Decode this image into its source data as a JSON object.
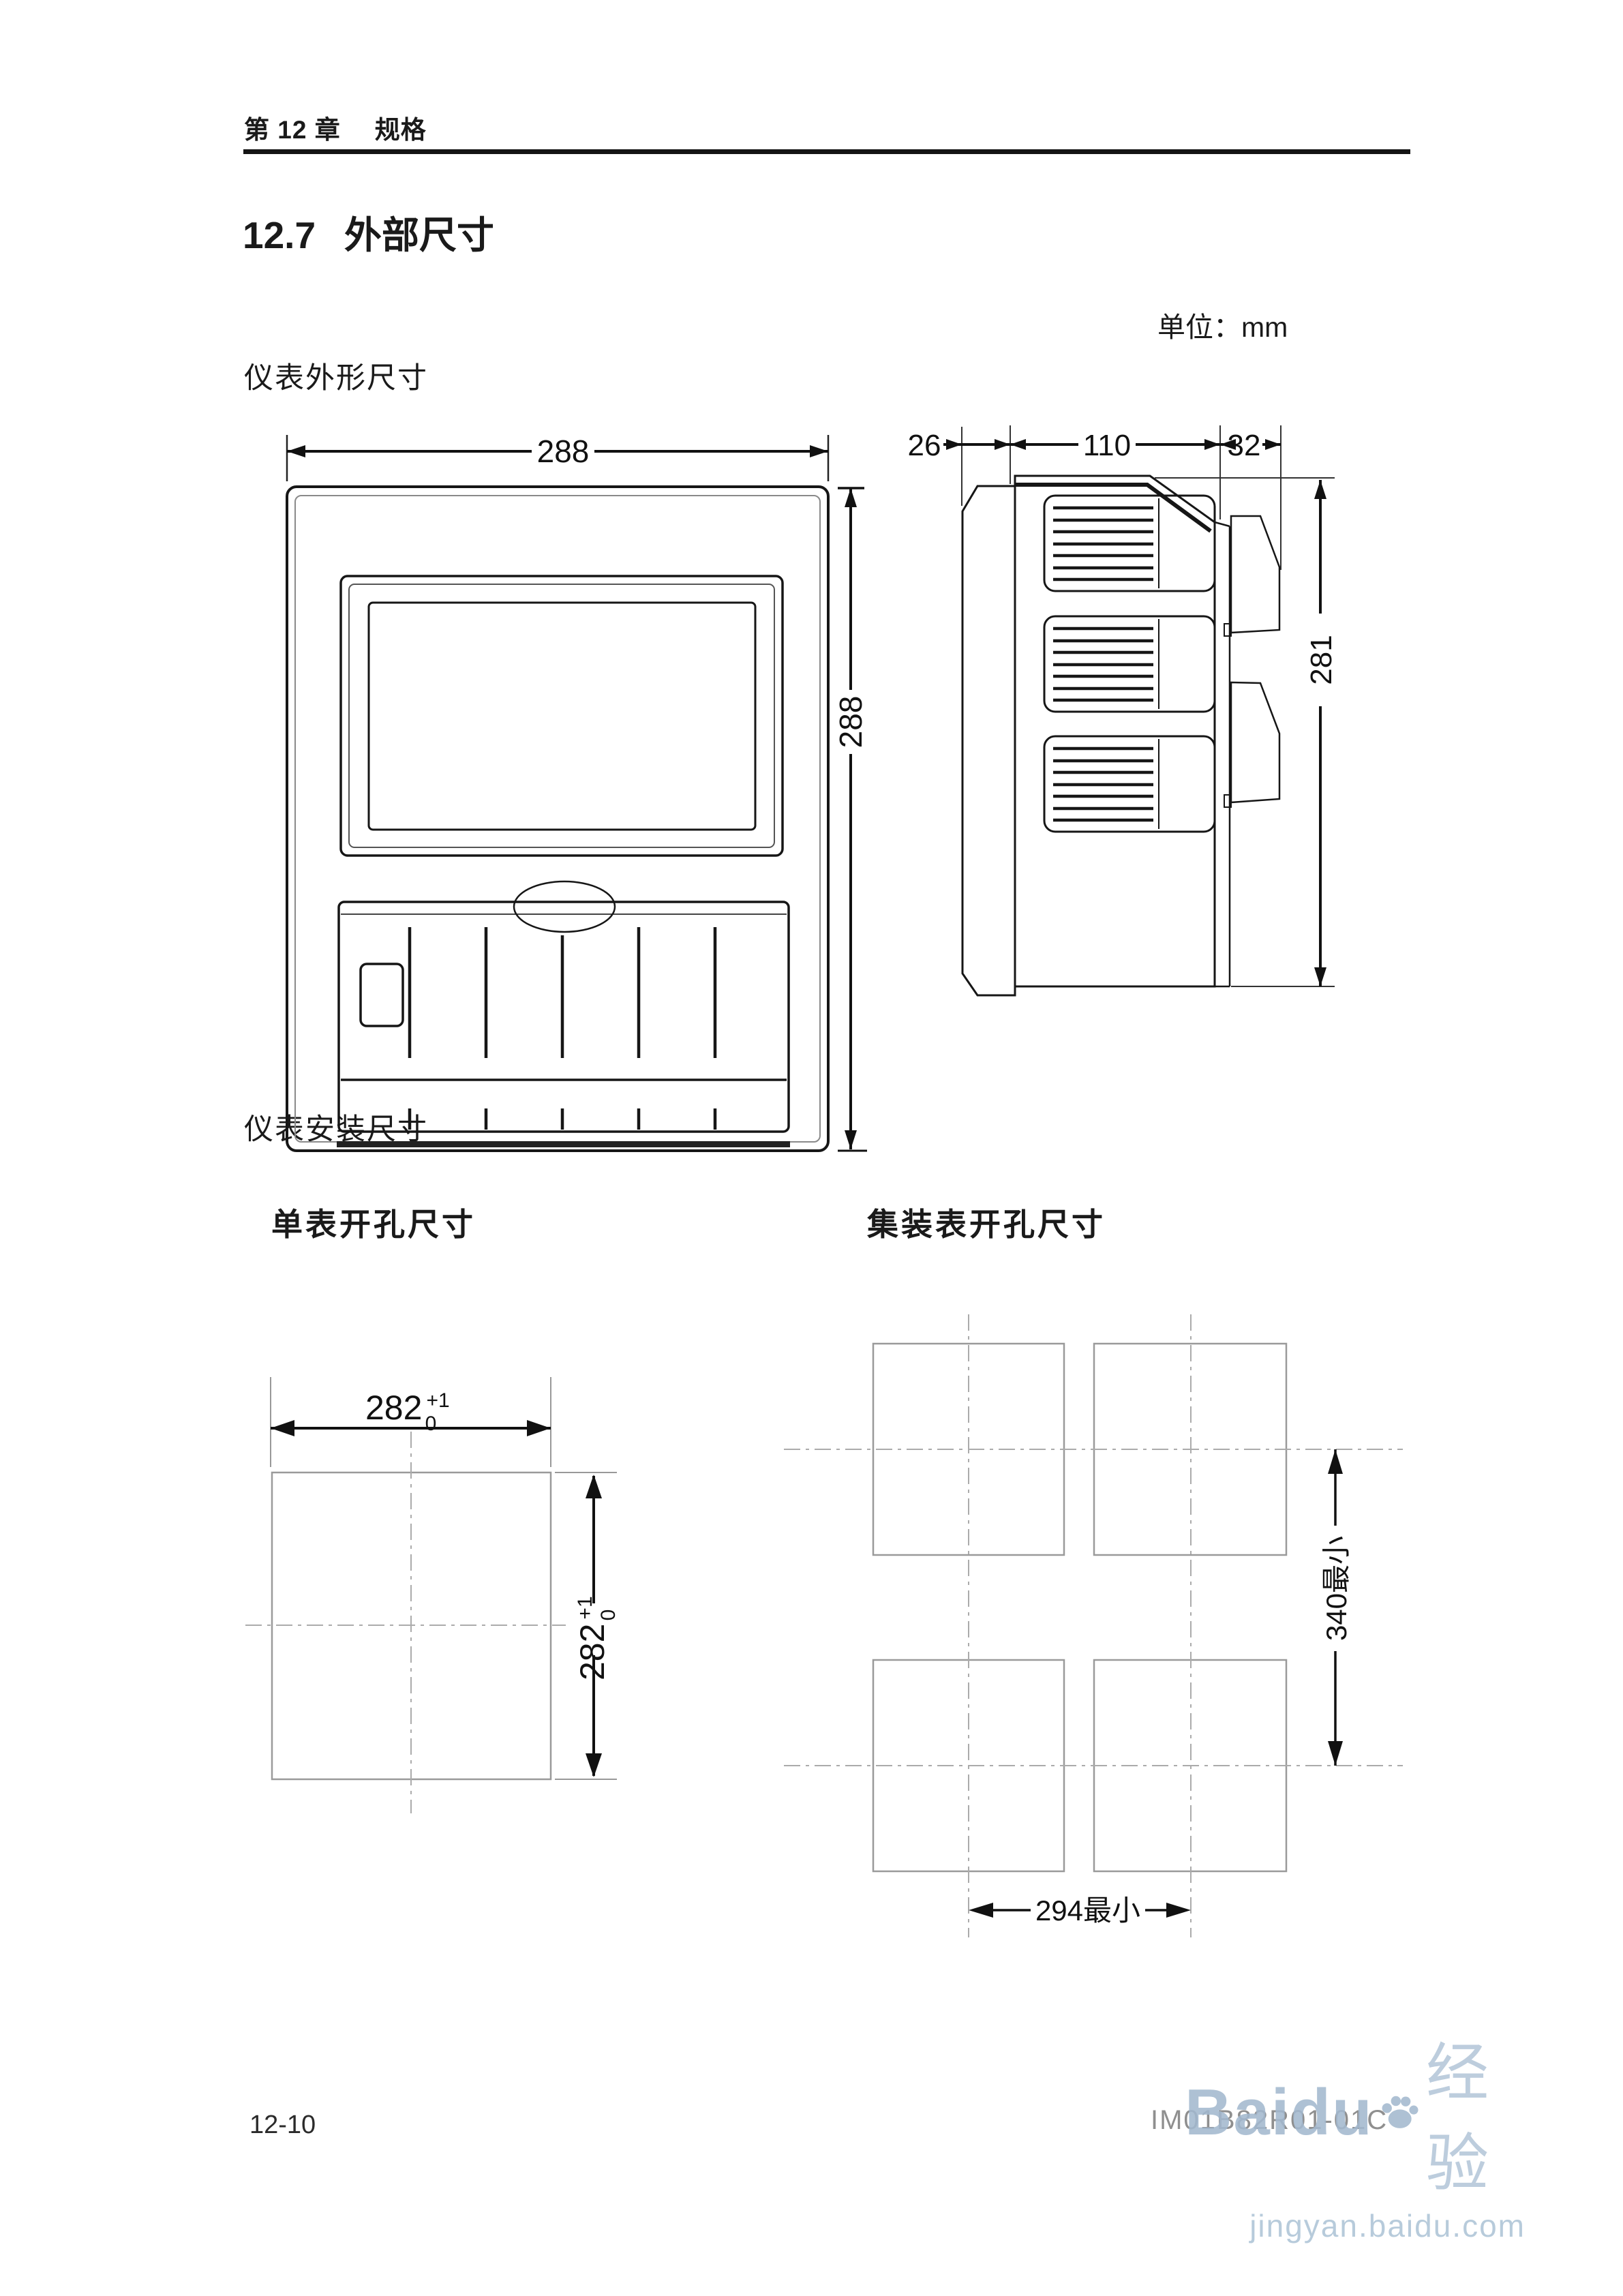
{
  "header": {
    "chapter": "第 12 章",
    "section_name": "规格"
  },
  "title": {
    "number": "12.7",
    "text": "外部尺寸"
  },
  "unit_note": "单位：mm",
  "figures": {
    "outline_label": "仪表外形尺寸",
    "mounting_label": "仪表安装尺寸",
    "front_view": {
      "width": "288",
      "height": "288"
    },
    "side_view": {
      "front_depth": "26",
      "body_depth": "110",
      "rear_depth": "32",
      "height": "281"
    },
    "single_cutout": {
      "heading": "单表开孔尺寸",
      "width": "282",
      "width_tol_upper": "+1",
      "width_tol_lower": "0",
      "height": "282",
      "height_tol_upper": "+1",
      "height_tol_lower": "0"
    },
    "cluster_cutout": {
      "heading": "集装表开孔尺寸",
      "vertical_min": "340最小",
      "horizontal_min": "294最小"
    }
  },
  "footer": {
    "page_number": "12-10",
    "doc_number": "IM01B82R01-01C"
  },
  "watermark": {
    "brand": "Baidu",
    "suffix": "经验",
    "url": "jingyan.baidu.com"
  }
}
